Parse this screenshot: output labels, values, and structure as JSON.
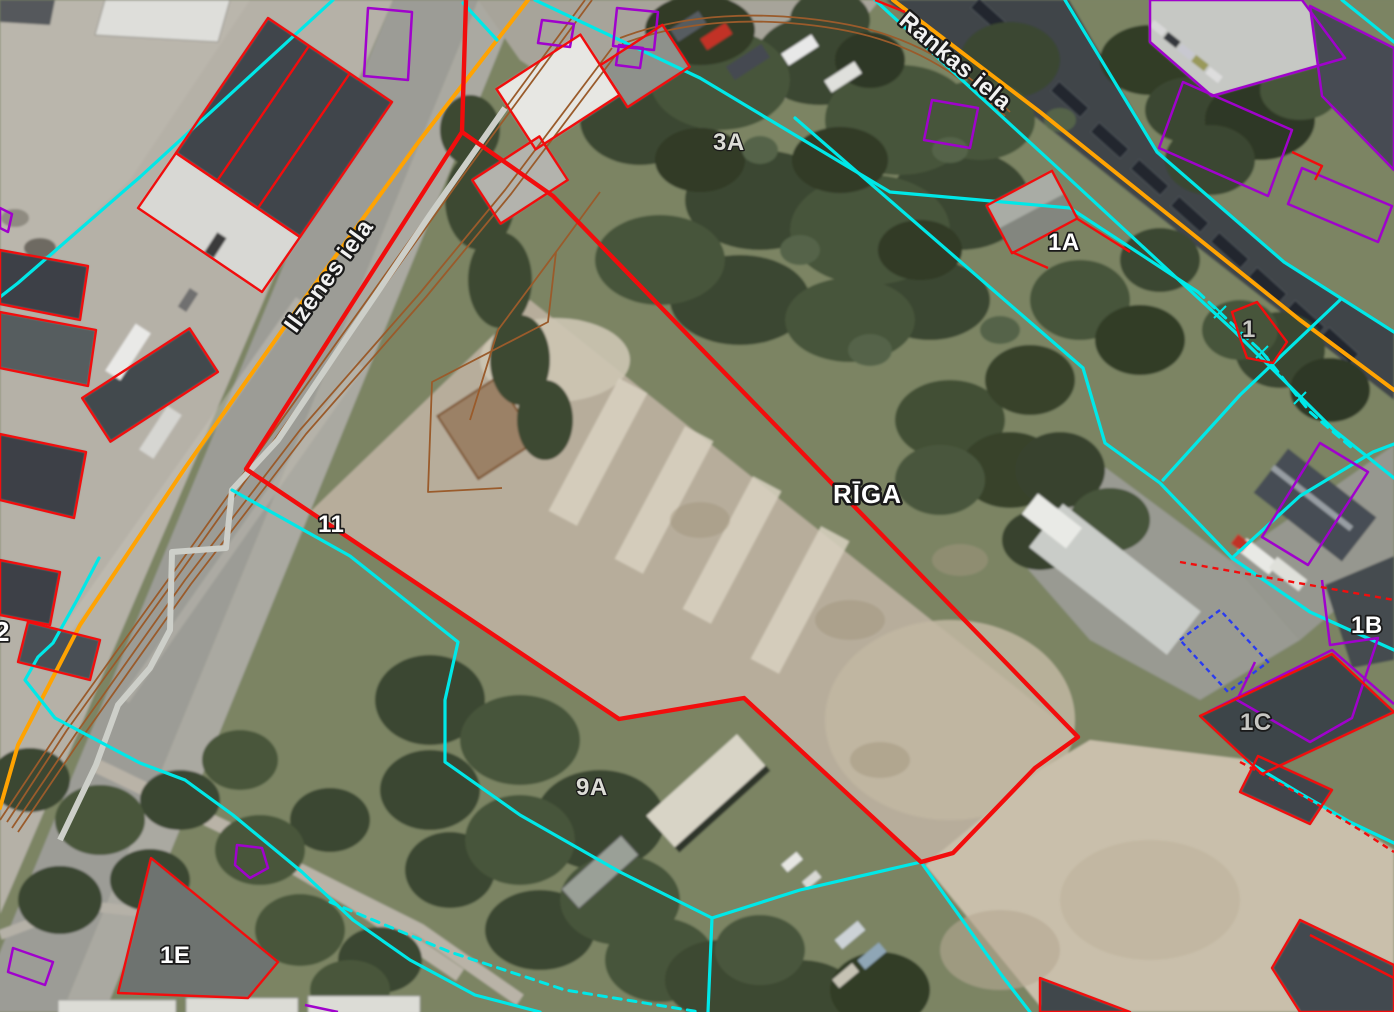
{
  "map": {
    "kind": "cadastral-orthophoto-viewer",
    "city": "Rīga"
  },
  "labels": {
    "city": "RĪGA",
    "rankas": "Rankas iela",
    "ilzenes": "Ilzenes iela",
    "p3a": "3A",
    "p1a": "1A",
    "p1": "1",
    "p11": "11",
    "p9a": "9A",
    "p1e": "1E",
    "p1b": "1B",
    "p1c": "1C",
    "p2": "2"
  },
  "colors": {
    "parcel_boundary_red": "#f20d0d",
    "cadastral_boundary_cyan": "#00e8e8",
    "building_outline_purple": "#a002cc",
    "building_outline_blue": "#2a3cf0",
    "street_centerline_orange": "#ffa302",
    "railway_brown": "#9a5b2b",
    "label_fill": "#ffffff",
    "label_outline": "#1a1a1a"
  }
}
